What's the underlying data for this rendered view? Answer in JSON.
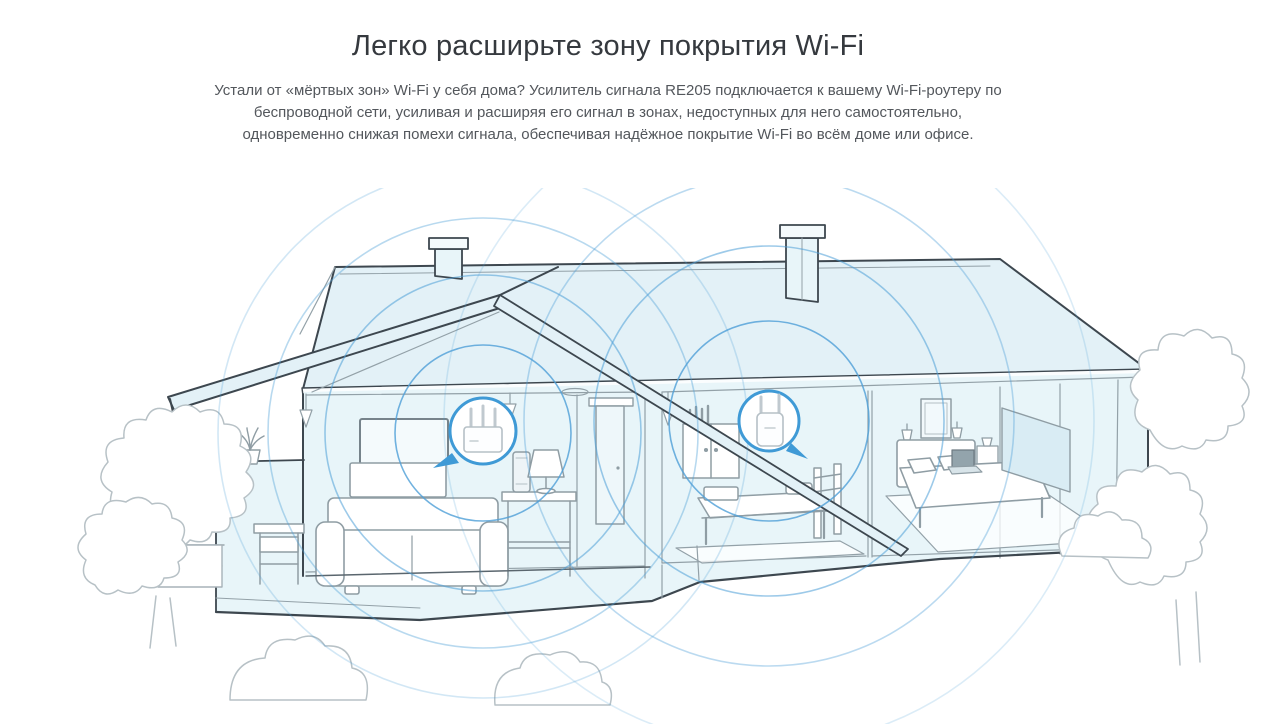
{
  "header": {
    "title": "Легко расширьте зону покрытия Wi-Fi",
    "description_lines": [
      "Устали от «мёртвых зон» Wi-Fi у себя дома? Усилитель сигнала RE205 подключается к вашему Wi-Fi-роутеру по",
      "беспроводной сети, усиливая и расширяя его сигнал в зонах, недоступных для него самостоятельно,",
      "одновременно снижая помехи сигнала, обеспечивая надёжное покрытие Wi-Fi во всём доме или офисе."
    ]
  },
  "illustration": {
    "description": "cutaway-house-with-wifi-coverage",
    "colors": {
      "house_fill": "#e8f5f9",
      "roof_fill": "#e3f1f7",
      "outline_dark": "#3d474f",
      "outline_gray": "#93a1a8",
      "tree_gray": "#b7c1c6",
      "wifi_ring_blue": "#4d9fd7",
      "callout_blue": "#3f9ad6"
    },
    "devices": [
      {
        "icon": "router-icon"
      },
      {
        "icon": "extender-icon"
      }
    ]
  }
}
